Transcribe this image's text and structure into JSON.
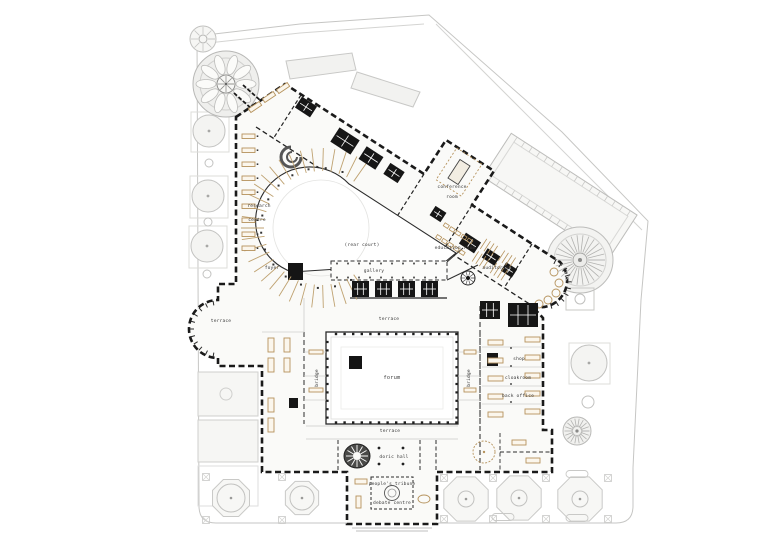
{
  "page": {
    "background": "#ffffff",
    "description": "architectural ground floor plan drawing"
  },
  "palette": {
    "wall": "#1a1a1a",
    "context_gray": "#c4c4c2",
    "furniture_tan": "#b5925c",
    "building_fill": "#fafaf8",
    "court_fill": "#ffffff",
    "label_text": "#3a3a3a"
  },
  "plan": {
    "type": "architectural-ground-floor-plan",
    "labels": {
      "research_line1": "research",
      "research_line2": "centre",
      "foyer": "foyer",
      "rear_court": "(rear court)",
      "gallery": "gallery",
      "conference_line1": "conference",
      "conference_line2": "room",
      "education_room": "education room",
      "auditorium": "auditorium",
      "shop": "shop",
      "cloakroom": "cloakroom",
      "back_office": "back office",
      "terrace_left": "terrace",
      "terrace_mid": "terrace",
      "terrace_bottom": "terrace",
      "forum": "forum",
      "bridge_left": "bridge",
      "bridge_right": "bridge",
      "doric_hall": "doric hall",
      "peoples_tribune": "people's tribune",
      "debate_centre": "debate centre"
    }
  }
}
